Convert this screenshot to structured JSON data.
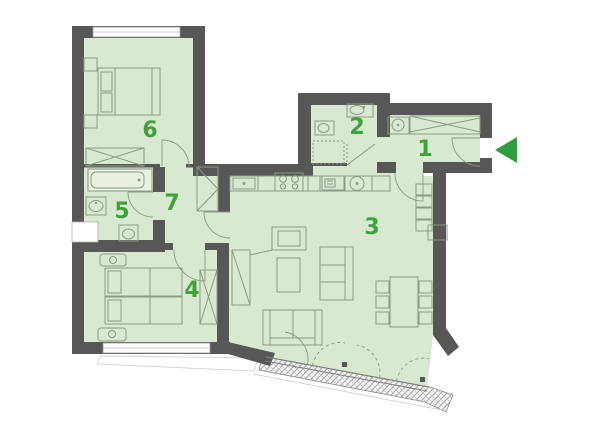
{
  "floorplan": {
    "title": "apartment-floor-plan",
    "rooms": [
      {
        "number": "1"
      },
      {
        "number": "2"
      },
      {
        "number": "3"
      },
      {
        "number": "4"
      },
      {
        "number": "5"
      },
      {
        "number": "6"
      },
      {
        "number": "7"
      }
    ],
    "entrance": {
      "arrow_direction": "left"
    },
    "colors": {
      "wall": "#575756",
      "floor": "#d9e8d0",
      "label_green": "#3fa33c",
      "arrow_green": "#2f9e3f",
      "furniture_line": "#8b9a86"
    }
  }
}
